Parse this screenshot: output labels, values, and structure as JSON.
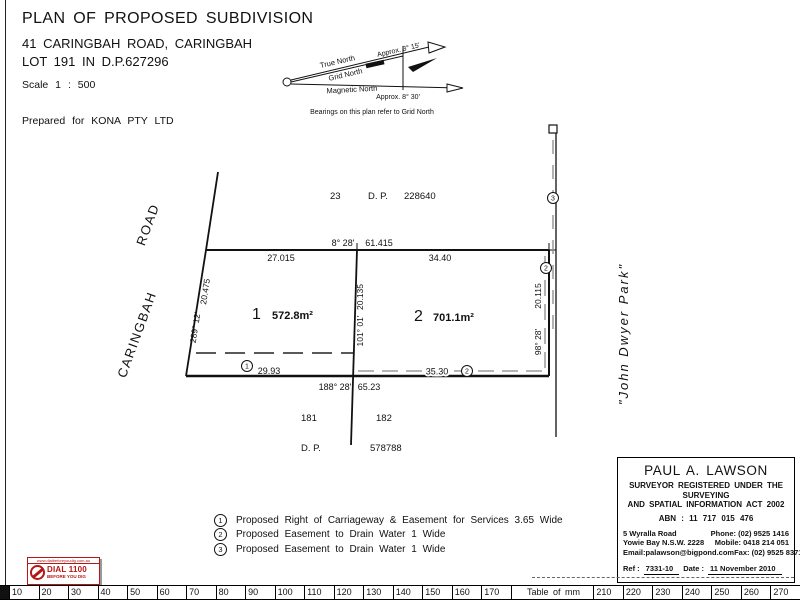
{
  "header": {
    "title": "PLAN OF PROPOSED SUBDIVISION",
    "address": "41 CARINGBAH ROAD, CARINGBAH",
    "lot": "LOT 191 IN D.P.627296",
    "scale_label": "Scale   1 : 500",
    "prepared_for": "Prepared for KONA PTY LTD"
  },
  "north_diagram": {
    "true_north": "True North",
    "grid_north": "Grid North",
    "magnetic_north": "Magnetic North",
    "approx_top": "Approx. 3° 15'",
    "approx_bottom": "Approx. 8° 30'",
    "caption": "Bearings on this plan refer to Grid North"
  },
  "plan": {
    "road_name_line1": "CARINGBAH",
    "road_name_line2": "ROAD",
    "park_name": "\"John  Dwyer  Park\"",
    "adjoining_top": {
      "lot": "23",
      "dp": "D. P.",
      "number": "228640"
    },
    "adjoining_bottom": {
      "lot_left": "181",
      "lot_right": "182",
      "dp": "D. P.",
      "number": "578788"
    },
    "lot1": {
      "number": "1",
      "area": "572.8m²"
    },
    "lot2": {
      "number": "2",
      "area": "701.1m²"
    },
    "dims": {
      "top_bearing": "8° 28'",
      "top_total": "61.415",
      "top_seg1": "27.015",
      "top_seg2": "34.40",
      "left_bearing": "289° 12'",
      "left_dist": "20.475",
      "mid_bearing": "101° 01'",
      "mid_dist": "20.135",
      "right_bearing": "98° 28'",
      "right_dist": "20.115",
      "bottom_bearing": "188° 28'",
      "bottom_dist": "65.23",
      "easement1_dist": "29.93",
      "easement2_dist": "35.30"
    },
    "markers": {
      "m1": "1",
      "m2a": "2",
      "m2b": "2",
      "m3": "3"
    }
  },
  "legend": {
    "items": [
      {
        "num": "1",
        "text": "Proposed Right of Carriageway & Easement for Services 3.65 Wide"
      },
      {
        "num": "2",
        "text": "Proposed Easement to Drain Water 1 Wide"
      },
      {
        "num": "3",
        "text": "Proposed Easement to Drain Water 1 Wide"
      }
    ]
  },
  "surveyor": {
    "name": "PAUL A. LAWSON",
    "reg_line1": "SURVEYOR REGISTERED UNDER THE SURVEYING",
    "reg_line2": "AND SPATIAL INFORMATION ACT 2002",
    "abn": "ABN : 11 717 015 476",
    "address1": "5 Wyralla Road",
    "address2": "Yowie Bay N.S.W. 2228",
    "email": "Email:palawson@bigpond.com",
    "phone": "Phone: (02) 9525 1416",
    "mobile": "Mobile: 0418 214 051",
    "fax": "Fax: (02) 9525 8371",
    "ref_label": "Ref :",
    "ref_value": "7331-10",
    "date_label": "Date :",
    "date_value": "11 November 2010"
  },
  "dig_logo": {
    "url": "www.dialbeforeyoudig.com.au",
    "line1": "DIAL 1100",
    "line2": "BEFORE YOU DIG",
    "red": "#b51616"
  },
  "ruler": {
    "table_label": "Table of mm",
    "cells": [
      "10",
      "20",
      "30",
      "40",
      "50",
      "60",
      "70",
      "80",
      "90",
      "100",
      "110",
      "120",
      "130",
      "140",
      "150",
      "160",
      "170",
      "Table of mm",
      "210",
      "220",
      "230",
      "240",
      "250",
      "260",
      "270"
    ]
  }
}
